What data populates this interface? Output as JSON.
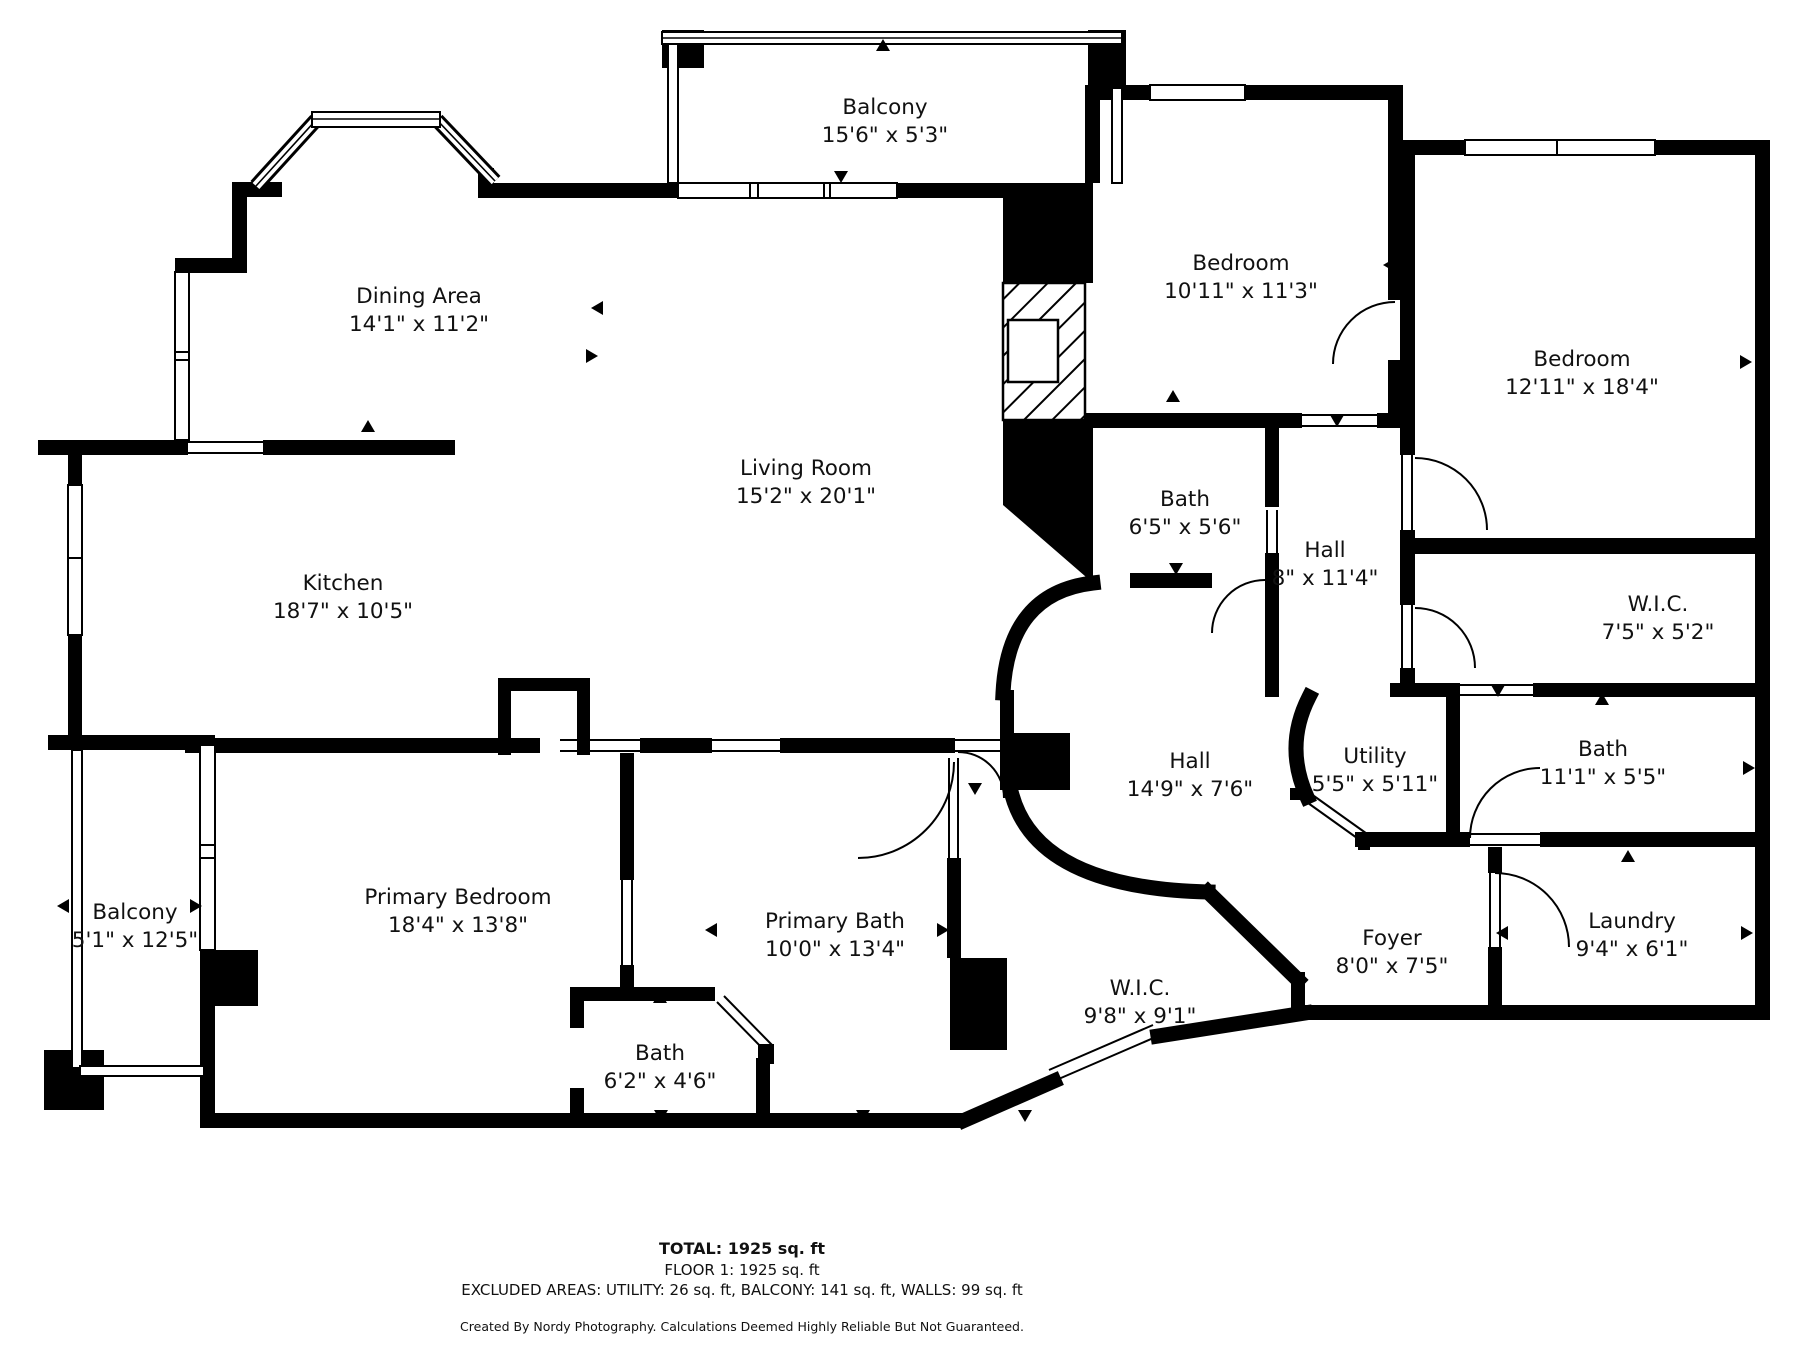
{
  "colors": {
    "background": "#ffffff",
    "walls": "#000000",
    "text": "#111111"
  },
  "rooms": [
    {
      "name": "Balcony",
      "dims": "15'6\" x 5'3\""
    },
    {
      "name": "Dining Area",
      "dims": "14'1\" x 11'2\""
    },
    {
      "name": "Living Room",
      "dims": "15'2\" x 20'1\""
    },
    {
      "name": "Kitchen",
      "dims": "18'7\" x 10'5\""
    },
    {
      "name": "Bedroom",
      "dims": "10'11\" x 11'3\""
    },
    {
      "name": "Bedroom",
      "dims": "12'11\" x 18'4\""
    },
    {
      "name": "Bath",
      "dims": "6'5\" x 5'6\""
    },
    {
      "name": "Hall",
      "dims": "8\" x 11'4\""
    },
    {
      "name": "W.I.C.",
      "dims": "7'5\" x 5'2\""
    },
    {
      "name": "Bath",
      "dims": "11'1\" x 5'5\""
    },
    {
      "name": "Utility",
      "dims": "5'5\" x 5'11\""
    },
    {
      "name": "Hall",
      "dims": "14'9\" x 7'6\""
    },
    {
      "name": "Foyer",
      "dims": "8'0\" x 7'5\""
    },
    {
      "name": "Laundry",
      "dims": "9'4\" x 6'1\""
    },
    {
      "name": "Primary Bedroom",
      "dims": "18'4\" x 13'8\""
    },
    {
      "name": "Primary Bath",
      "dims": "10'0\" x 13'4\""
    },
    {
      "name": "W.I.C.",
      "dims": "9'8\" x 9'1\""
    },
    {
      "name": "Bath",
      "dims": "6'2\" x 4'6\""
    },
    {
      "name": "Balcony",
      "dims": "5'1\" x 12'5\""
    }
  ],
  "footer": {
    "total": "TOTAL: 1925 sq. ft",
    "floor": "FLOOR 1: 1925 sq. ft",
    "excluded": "EXCLUDED AREAS: UTILITY: 26 sq. ft, BALCONY: 141 sq. ft, WALLS: 99 sq. ft",
    "credit": "Created By Nordy Photography. Calculations Deemed Highly Reliable But Not Guaranteed."
  }
}
